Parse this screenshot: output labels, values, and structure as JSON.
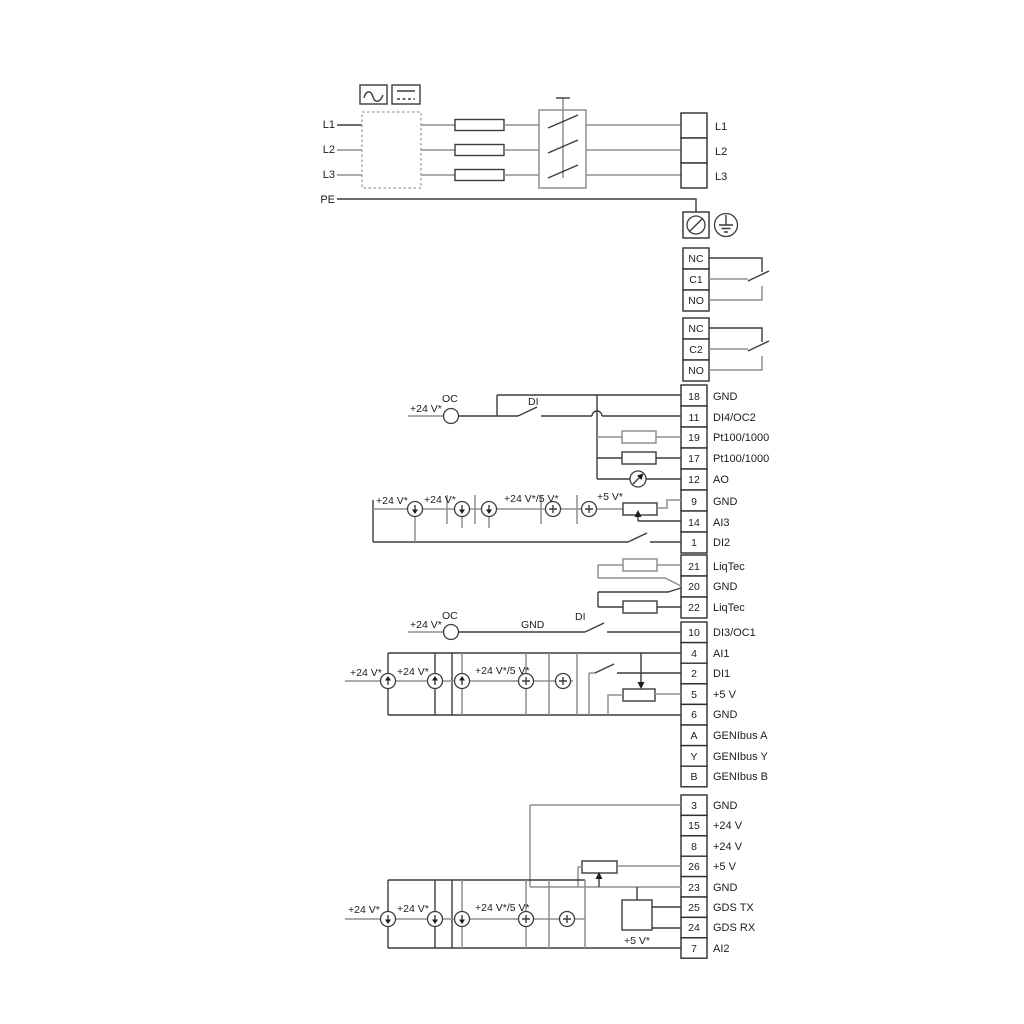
{
  "colors": {
    "background": "#ffffff",
    "wire_dark": "#3c3c3c",
    "wire_grey": "#8f8f8f",
    "text": "#1c1c1c"
  },
  "supply": {
    "lines_left": [
      "L1",
      "L2",
      "L3",
      "PE"
    ],
    "terminals_right": [
      "L1",
      "L2",
      "L3"
    ]
  },
  "relays": {
    "r1": [
      "NC",
      "C1",
      "NO"
    ],
    "r2": [
      "NC",
      "C2",
      "NO"
    ]
  },
  "blockA": [
    {
      "num": "18",
      "label": "GND"
    },
    {
      "num": "11",
      "label": "DI4/OC2"
    },
    {
      "num": "19",
      "label": "Pt100/1000"
    },
    {
      "num": "17",
      "label": "Pt100/1000"
    },
    {
      "num": "12",
      "label": "AO"
    },
    {
      "num": "9",
      "label": "GND"
    },
    {
      "num": "14",
      "label": "AI3"
    },
    {
      "num": "1",
      "label": "DI2"
    }
  ],
  "blockB": [
    {
      "num": "21",
      "label": "LiqTec"
    },
    {
      "num": "20",
      "label": "GND"
    },
    {
      "num": "22",
      "label": "LiqTec"
    }
  ],
  "blockC": [
    {
      "num": "10",
      "label": "DI3/OC1"
    },
    {
      "num": "4",
      "label": "AI1"
    },
    {
      "num": "2",
      "label": "DI1"
    },
    {
      "num": "5",
      "label": "+5 V"
    },
    {
      "num": "6",
      "label": "GND"
    },
    {
      "num": "A",
      "label": "GENIbus A"
    },
    {
      "num": "Y",
      "label": "GENIbus Y"
    },
    {
      "num": "B",
      "label": "GENIbus B"
    }
  ],
  "blockD": [
    {
      "num": "3",
      "label": "GND"
    },
    {
      "num": "15",
      "label": "+24 V"
    },
    {
      "num": "8",
      "label": "+24 V"
    },
    {
      "num": "26",
      "label": "+5 V"
    },
    {
      "num": "23",
      "label": "GND"
    },
    {
      "num": "25",
      "label": "GDS TX"
    },
    {
      "num": "24",
      "label": "GDS RX"
    },
    {
      "num": "7",
      "label": "AI2"
    }
  ],
  "ann": {
    "r11_v24": "+24 V*",
    "r11_oc": "OC",
    "r11_di": "DI",
    "ai3_v24a": "+24 V*",
    "ai3_v24b": "+24 V*",
    "ai3_v24v5": "+24 V*/5 V*",
    "ai3_v5": "+5 V*",
    "r10_v24": "+24 V*",
    "r10_oc": "OC",
    "r10_gnd": "GND",
    "r10_di": "DI",
    "ai1_v24a": "+24 V*",
    "ai1_v24b": "+24 V*",
    "ai1_v24v5": "+24 V*/5 V*",
    "ai2_v24a": "+24 V*",
    "ai2_v24b": "+24 V*",
    "ai2_v24v5": "+24 V*/5 V*",
    "ai2_v5": "+5 V*"
  }
}
